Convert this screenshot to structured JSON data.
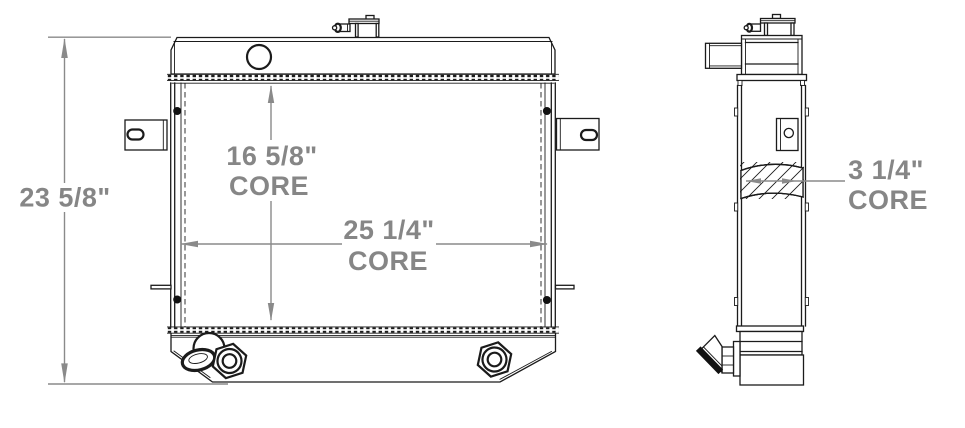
{
  "drawing": {
    "kind": "radiator-dimension-diagram",
    "colors": {
      "background": "#ffffff",
      "linework": "#1b1b1b",
      "dimension_lines": "#8a8a8a",
      "dimension_text": "#868686"
    },
    "dimensions": {
      "overall_height": {
        "value": "23 5/8\""
      },
      "core_height": {
        "value": "16 5/8\"",
        "label": "CORE"
      },
      "core_width": {
        "value": "25 1/4\"",
        "label": "CORE"
      },
      "core_depth": {
        "value": "3 1/4\"",
        "label": "CORE"
      }
    }
  }
}
